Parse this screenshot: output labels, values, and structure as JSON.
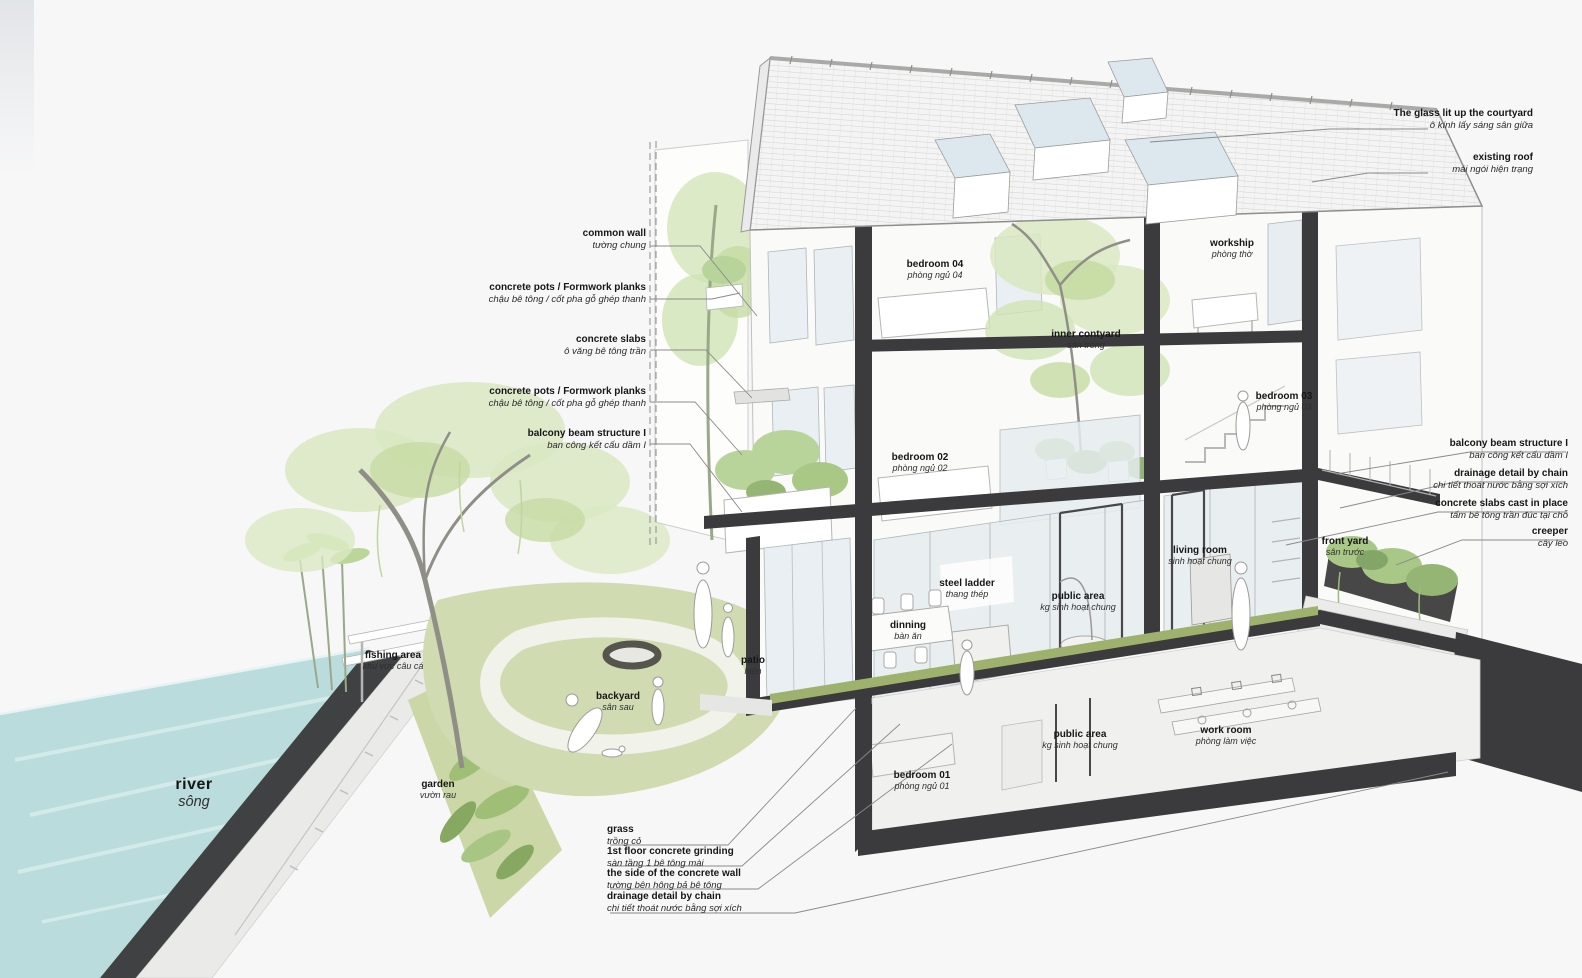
{
  "colors": {
    "background": "#f7f7f8",
    "ink": "#161616",
    "section_cut": "#3b3b3d",
    "river_water": "#badcdc",
    "embankment": "#3f4143",
    "lawn": "#d0dbb2",
    "grass_band": "#9fb26d",
    "foliage_light": "#d9e8c2",
    "foliage_dark": "#a9c786",
    "glass": "#e7edf0",
    "leader_line": "#8a8a8a",
    "roof_tile": "#c9c9c7"
  },
  "callouts": {
    "left": [
      {
        "en": "common wall",
        "vi": "tường chung"
      },
      {
        "en": "concrete pots / Formwork planks",
        "vi": "chậu bê tông / cốt pha gỗ ghép thanh"
      },
      {
        "en": "concrete slabs",
        "vi": "ô văng bê tông trần"
      },
      {
        "en": "concrete pots / Formwork planks",
        "vi": "chậu bê tông / cốt pha gỗ ghép thanh"
      },
      {
        "en": "balcony beam structure I",
        "vi": "ban công  kết cấu dầm I"
      }
    ],
    "right": [
      {
        "en": "The glass lit up the courtyard",
        "vi": "ô kính lấy sáng sân giữa"
      },
      {
        "en": "existing roof",
        "vi": "mái ngói hiện trạng"
      },
      {
        "en": "balcony beam structure I",
        "vi": "ban công  kết cấu dầm I"
      },
      {
        "en": "drainage detail by chain",
        "vi": "chi tiết thoát nước bằng sợi xích"
      },
      {
        "en": "concrete slabs cast in place",
        "vi": "tấm bê tông trần đúc tại chỗ"
      },
      {
        "en": "creeper",
        "vi": "cây leo"
      }
    ],
    "bottom": [
      {
        "en": "grass",
        "vi": "trồng cỏ"
      },
      {
        "en": "1st floor concrete grinding",
        "vi": "sàn tầng 1 bê tông mài"
      },
      {
        "en": "the side of the concrete wall",
        "vi": "tường bên hông bả  bê tông"
      },
      {
        "en": "drainage detail by chain",
        "vi": "chi tiết thoát nước bằng sợi xích"
      }
    ]
  },
  "rooms": [
    {
      "en": "bedroom 04",
      "vi": "phòng ngủ 04"
    },
    {
      "en": "workship",
      "vi": "phòng thờ"
    },
    {
      "en": "inner contyard",
      "vi": "sân trong"
    },
    {
      "en": "bedroom 03",
      "vi": "phòng ngủ 03"
    },
    {
      "en": "bedroom 02",
      "vi": "phòng ngủ 02"
    },
    {
      "en": "living room",
      "vi": "sinh hoạt chung"
    },
    {
      "en": "steel ladder",
      "vi": "thang thép"
    },
    {
      "en": "public area",
      "vi": "kg sinh hoạt chung"
    },
    {
      "en": "dinning",
      "vi": "bàn ăn"
    },
    {
      "en": "patio",
      "vi": "hiên"
    },
    {
      "en": "front yard",
      "vi": "sân trước"
    },
    {
      "en": "bedroom 01",
      "vi": "phòng ngủ 01"
    },
    {
      "en": "public area",
      "vi": "kg sinh hoạt chung"
    },
    {
      "en": "work room",
      "vi": "phòng làm việc"
    }
  ],
  "site": [
    {
      "en": "fishing area",
      "vi": "khu vực câu cá"
    },
    {
      "en": "backyard",
      "vi": "sân sau"
    },
    {
      "en": "garden",
      "vi": "vườn rau"
    },
    {
      "en": "river",
      "vi": "sông"
    }
  ]
}
